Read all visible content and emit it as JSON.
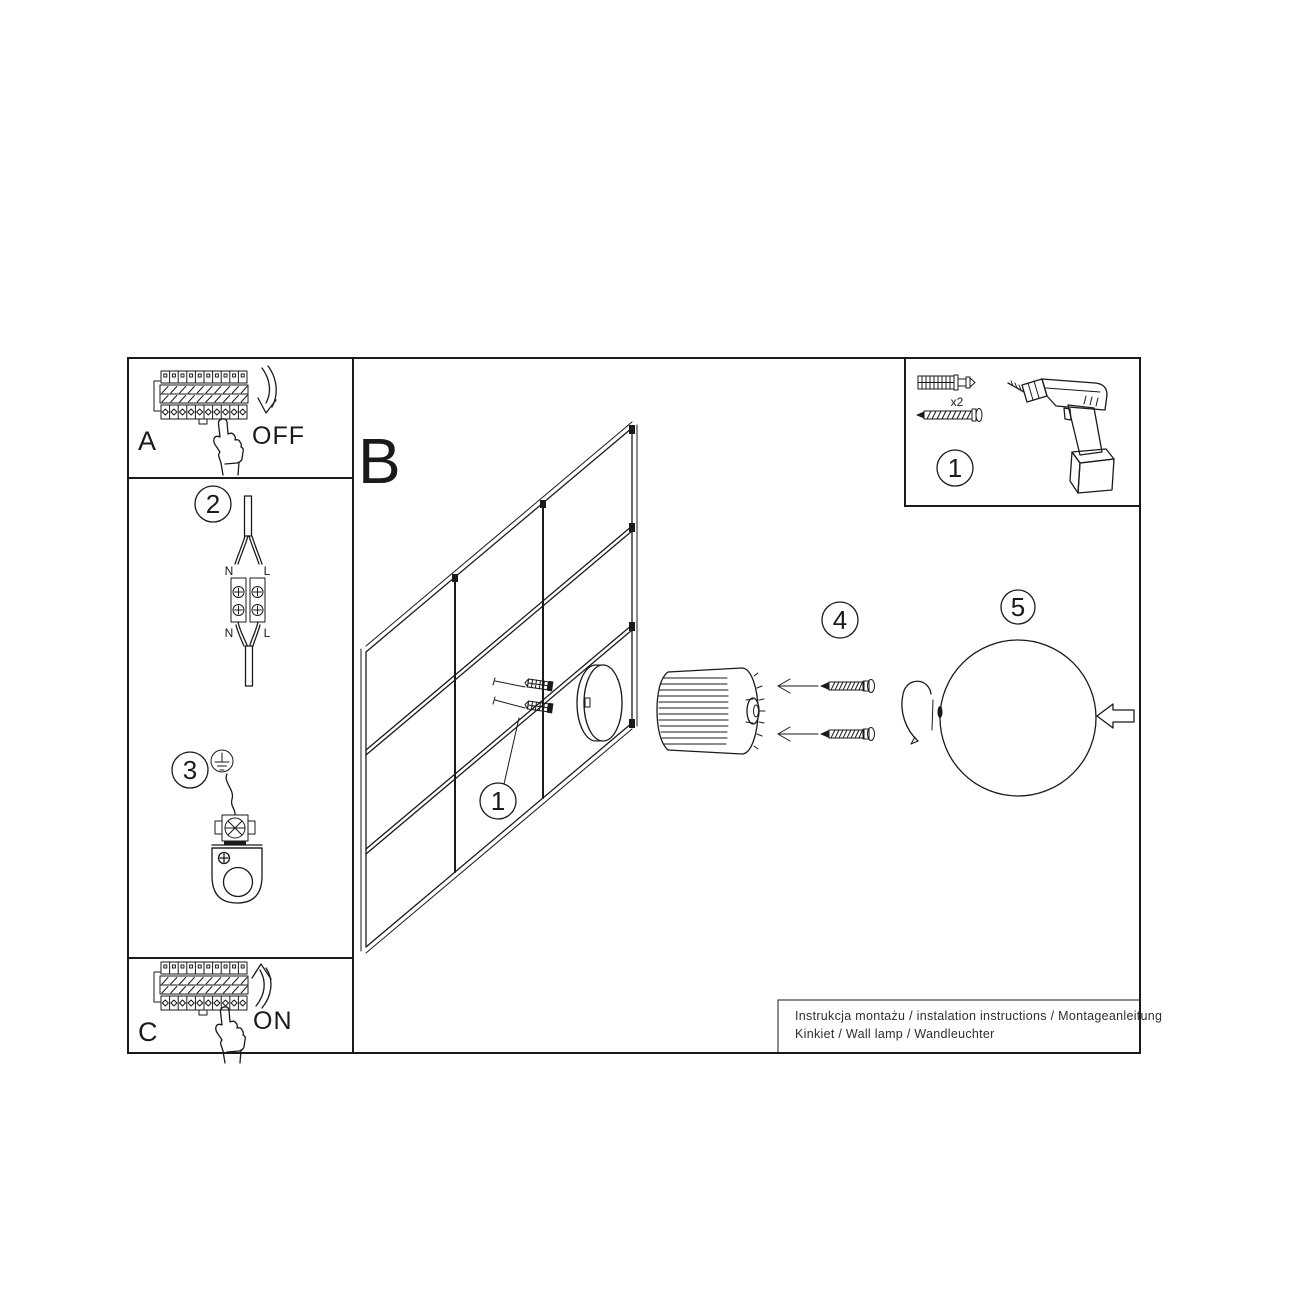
{
  "panels": {
    "a": {
      "label": "A",
      "state": "OFF"
    },
    "c": {
      "label": "C",
      "state": "ON"
    },
    "b": {
      "label": "B"
    }
  },
  "steps": {
    "parts": "1",
    "wire": "2",
    "ground": "3",
    "anchor": "1",
    "screws": "4",
    "shade": "5"
  },
  "wiring": {
    "top_n": "N",
    "top_l": "L",
    "bottom_n": "N",
    "bottom_l": "L"
  },
  "parts": {
    "quantity": "x2"
  },
  "footer": {
    "line1": "Instrukcja montażu / instalation instructions / Montageanleitung",
    "line2": "Kinkiet / Wall lamp / Wandleuchter"
  },
  "colors": {
    "line": "#1a1a1a",
    "background": "#ffffff",
    "footer_text": "#2e2e2e"
  },
  "icons": [
    "breaker-panel-icon",
    "pointing-hand-icon",
    "curved-arrow-down-icon",
    "curved-arrow-up-icon",
    "power-cable-icon",
    "terminal-block-icon",
    "ground-symbol-icon",
    "ground-terminal-icon",
    "mounting-bracket-icon",
    "wall-plug-icon",
    "screw-icon",
    "drill-icon",
    "wall-grid",
    "mount-ring-icon",
    "lamp-body-icon",
    "hook-wire-icon",
    "glass-ball-icon",
    "left-arrow-icon"
  ]
}
